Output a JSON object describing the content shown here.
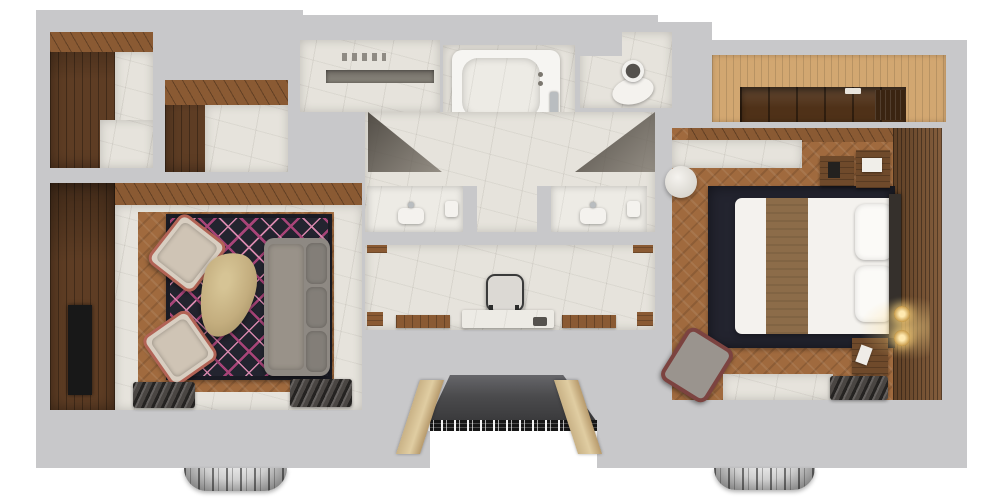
{
  "meta": {
    "title": "Hotel suite - 3D top-down floor plan render",
    "view": "overhead dollhouse render",
    "visible_text": "none"
  },
  "palette": {
    "bg": "#ffffff",
    "wall": "#c8c8ca",
    "wood_dark": "#5e3d24",
    "wood_mid": "#8a5a33",
    "wood_floor": "#a06a3e",
    "wood_light": "#d2a771",
    "marble": "#e6e3dc",
    "rug_navy": "#23242f",
    "rug_magenta": "#a84478",
    "rug_pink": "#d687ac",
    "sofa_gray": "#8e8983",
    "chair_beige": "#d8cec1",
    "chair_pipe": "#b26355",
    "table_gold": "#c3ad7e",
    "bed_white": "#f4f2ee",
    "runner_brown": "#8c6c49",
    "headboard": "#35302c",
    "drape_dark": "#4a4643",
    "entry_floor": "#4b4b4d",
    "mosaic_black": "#161616",
    "tv_black": "#181818",
    "chrome": "#b9bdc0",
    "maroon": "#7c4340"
  },
  "rooms": {
    "closet_one": {
      "label": "Walk-in closet (wood panelled, marble floor)"
    },
    "closet_two": {
      "label": "Closet (wood panelled, marble floor)"
    },
    "living_room": {
      "label": "Living room",
      "furniture": [
        "gray sofa",
        "two beige armchairs with red piping",
        "organic coffee table",
        "navy chevron rug",
        "TV on wood wall",
        "window drapes"
      ]
    },
    "shower_room": {
      "label": "Walk-in shower (marble, recessed niche)"
    },
    "bathtub_room": {
      "label": "Bathtub room (marble deck tub)"
    },
    "wc": {
      "label": "Toilet room"
    },
    "bathroom_hall": {
      "label": "Bathroom hall",
      "features": [
        "left vanity with sink",
        "right vanity with sink",
        "glass door shadows"
      ]
    },
    "dressing_area": {
      "label": "Dressing area",
      "furniture": [
        "vanity chair",
        "marble vanity table",
        "wood runner mats"
      ]
    },
    "wardrobe": {
      "label": "Built-in wardrobe (light wood front, dark interior)"
    },
    "bedroom": {
      "label": "Bedroom",
      "furniture": [
        "king bed with brown runner",
        "two pillows",
        "navy rug",
        "two nightstands",
        "desk with laptop",
        "round side table",
        "maroon armchair",
        "wall sconces",
        "slat headboard wall",
        "window drapes"
      ]
    },
    "entry": {
      "label": "Entry vestibule with mosaic threshold"
    }
  },
  "fixtures": {
    "chandeliers": {
      "count": 2,
      "label": "Chandeliers visible below bottom wall edge"
    }
  }
}
